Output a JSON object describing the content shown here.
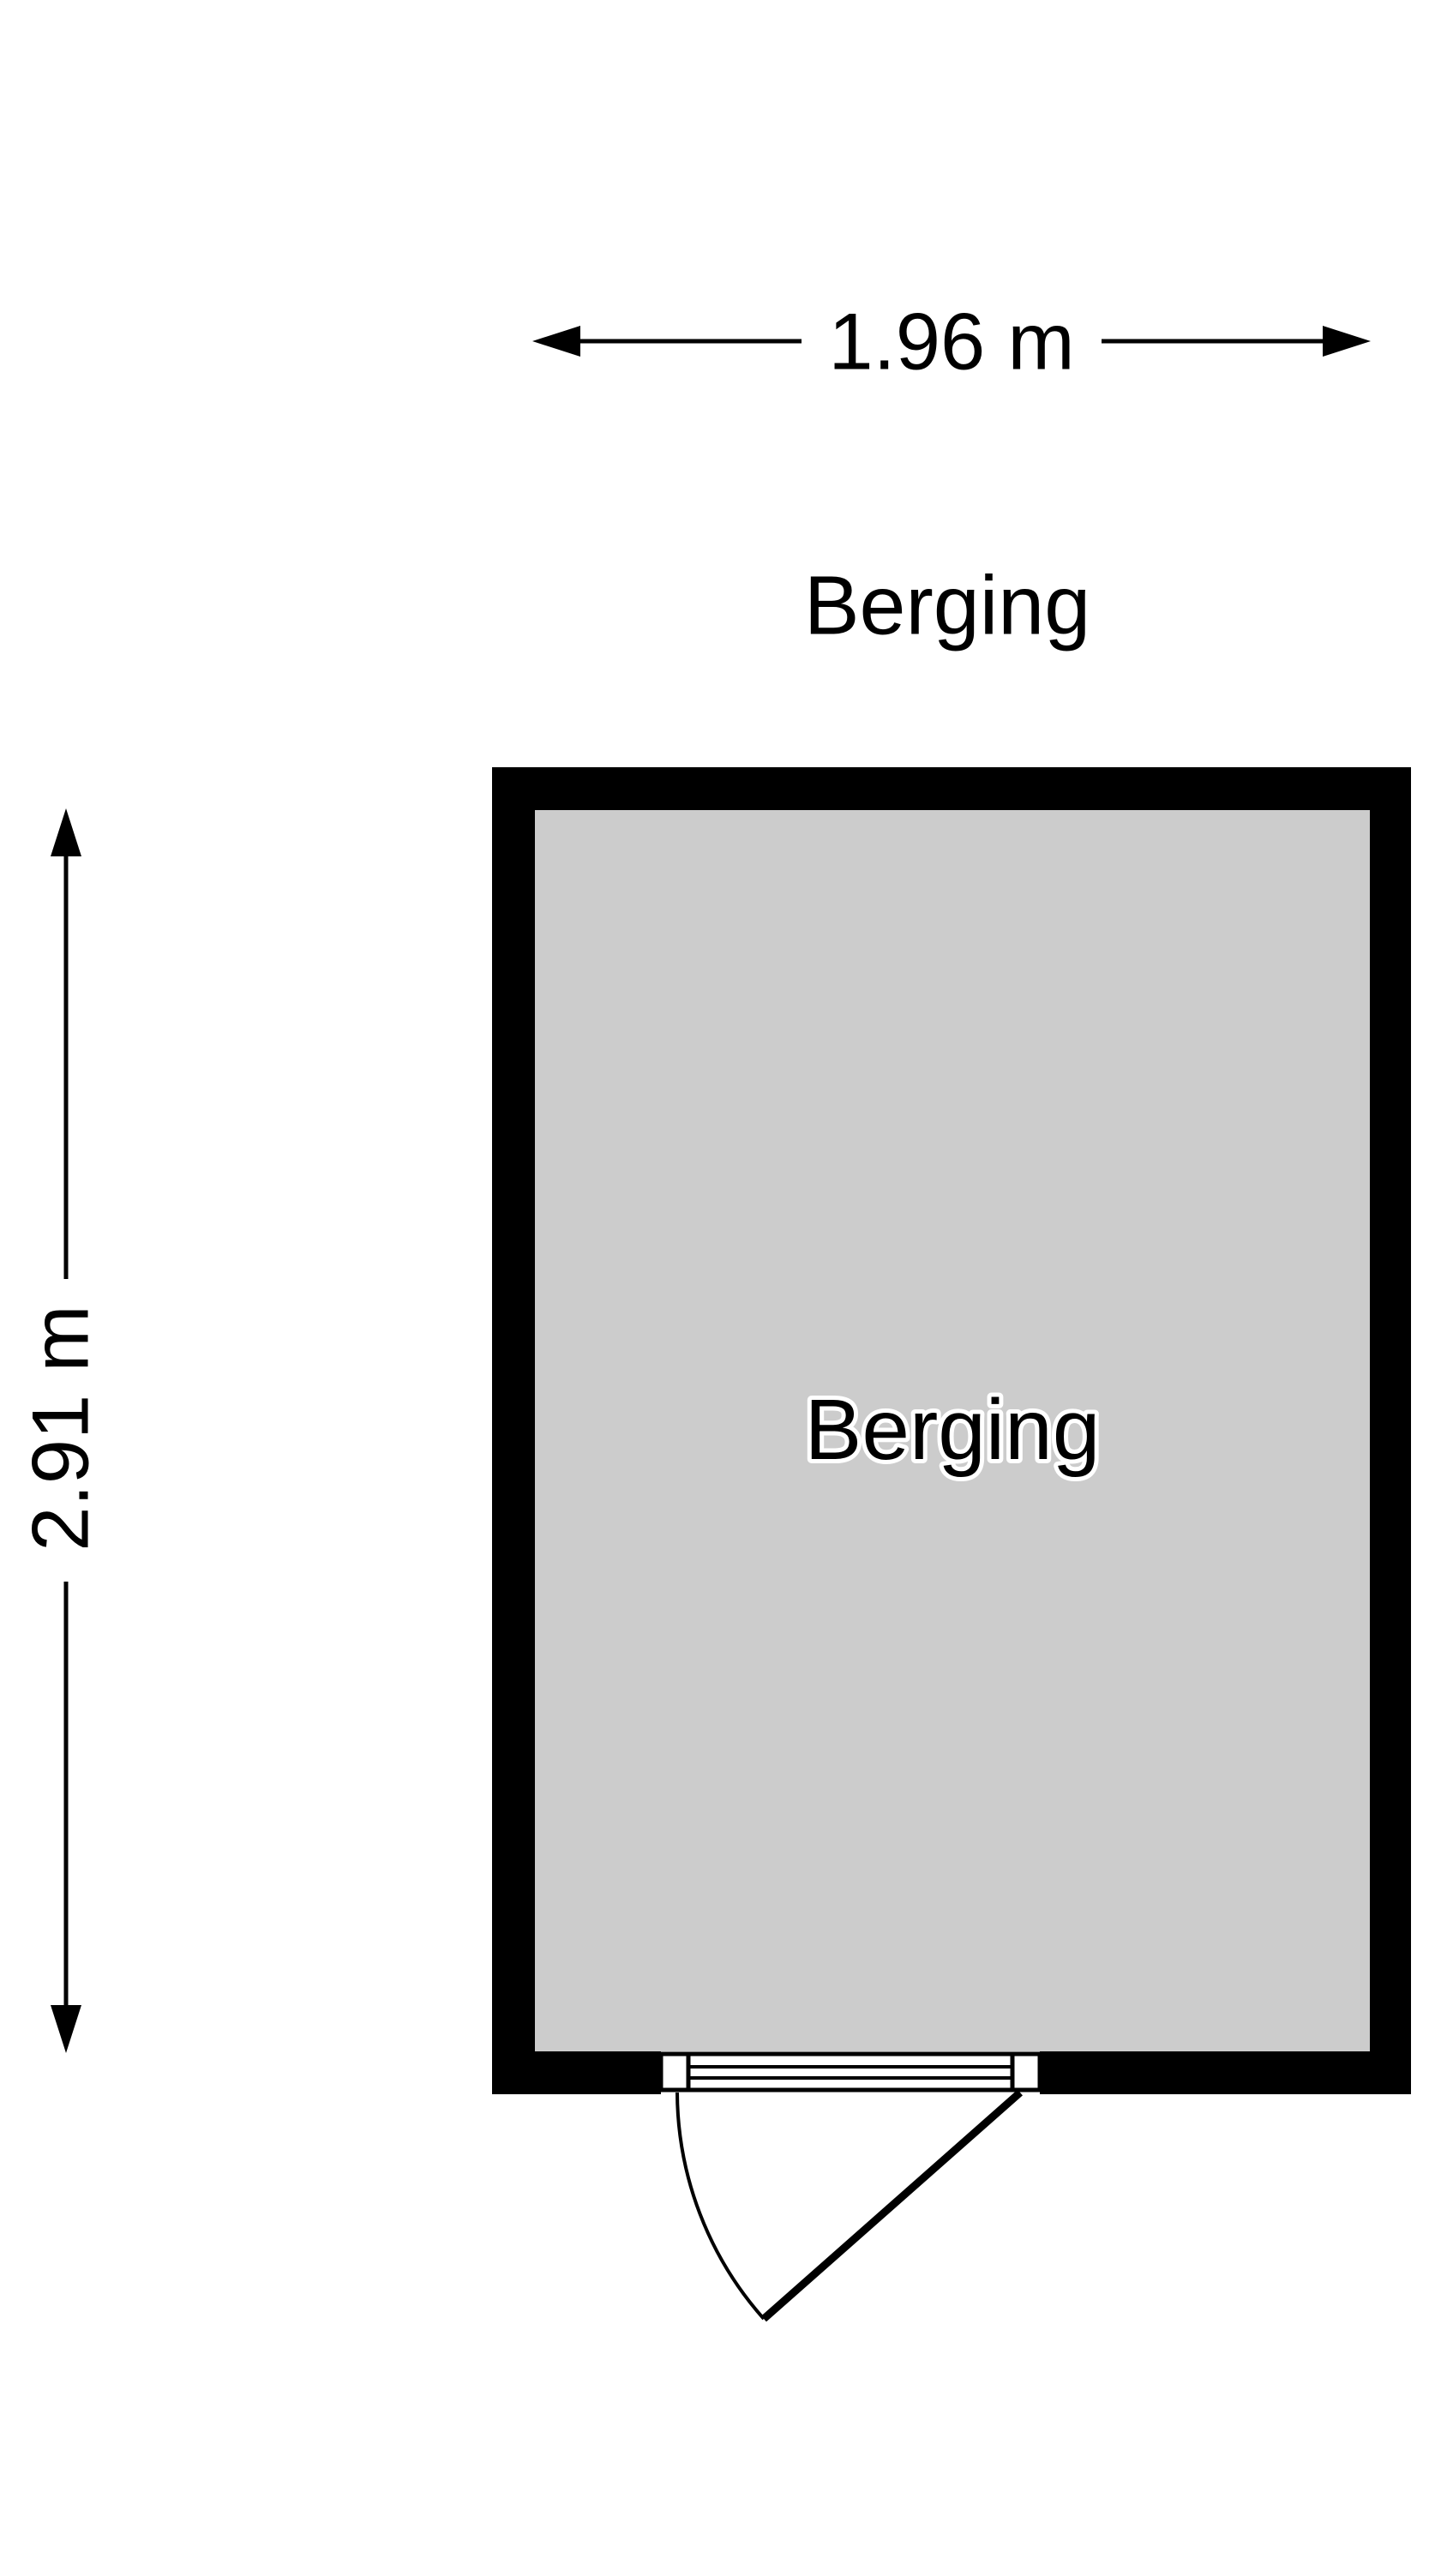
{
  "canvas": {
    "background": "#ffffff"
  },
  "floorplan": {
    "title": "Berging",
    "room": {
      "label": "Berging",
      "wall_color": "#000000",
      "floor_color": "#cccccc"
    },
    "dimensions": {
      "width_label": "1.96 m",
      "height_label": "2.91 m"
    },
    "door": {
      "type": "single-swing-door",
      "hinge_side": "right",
      "swing_direction": "outward-bottom"
    }
  }
}
